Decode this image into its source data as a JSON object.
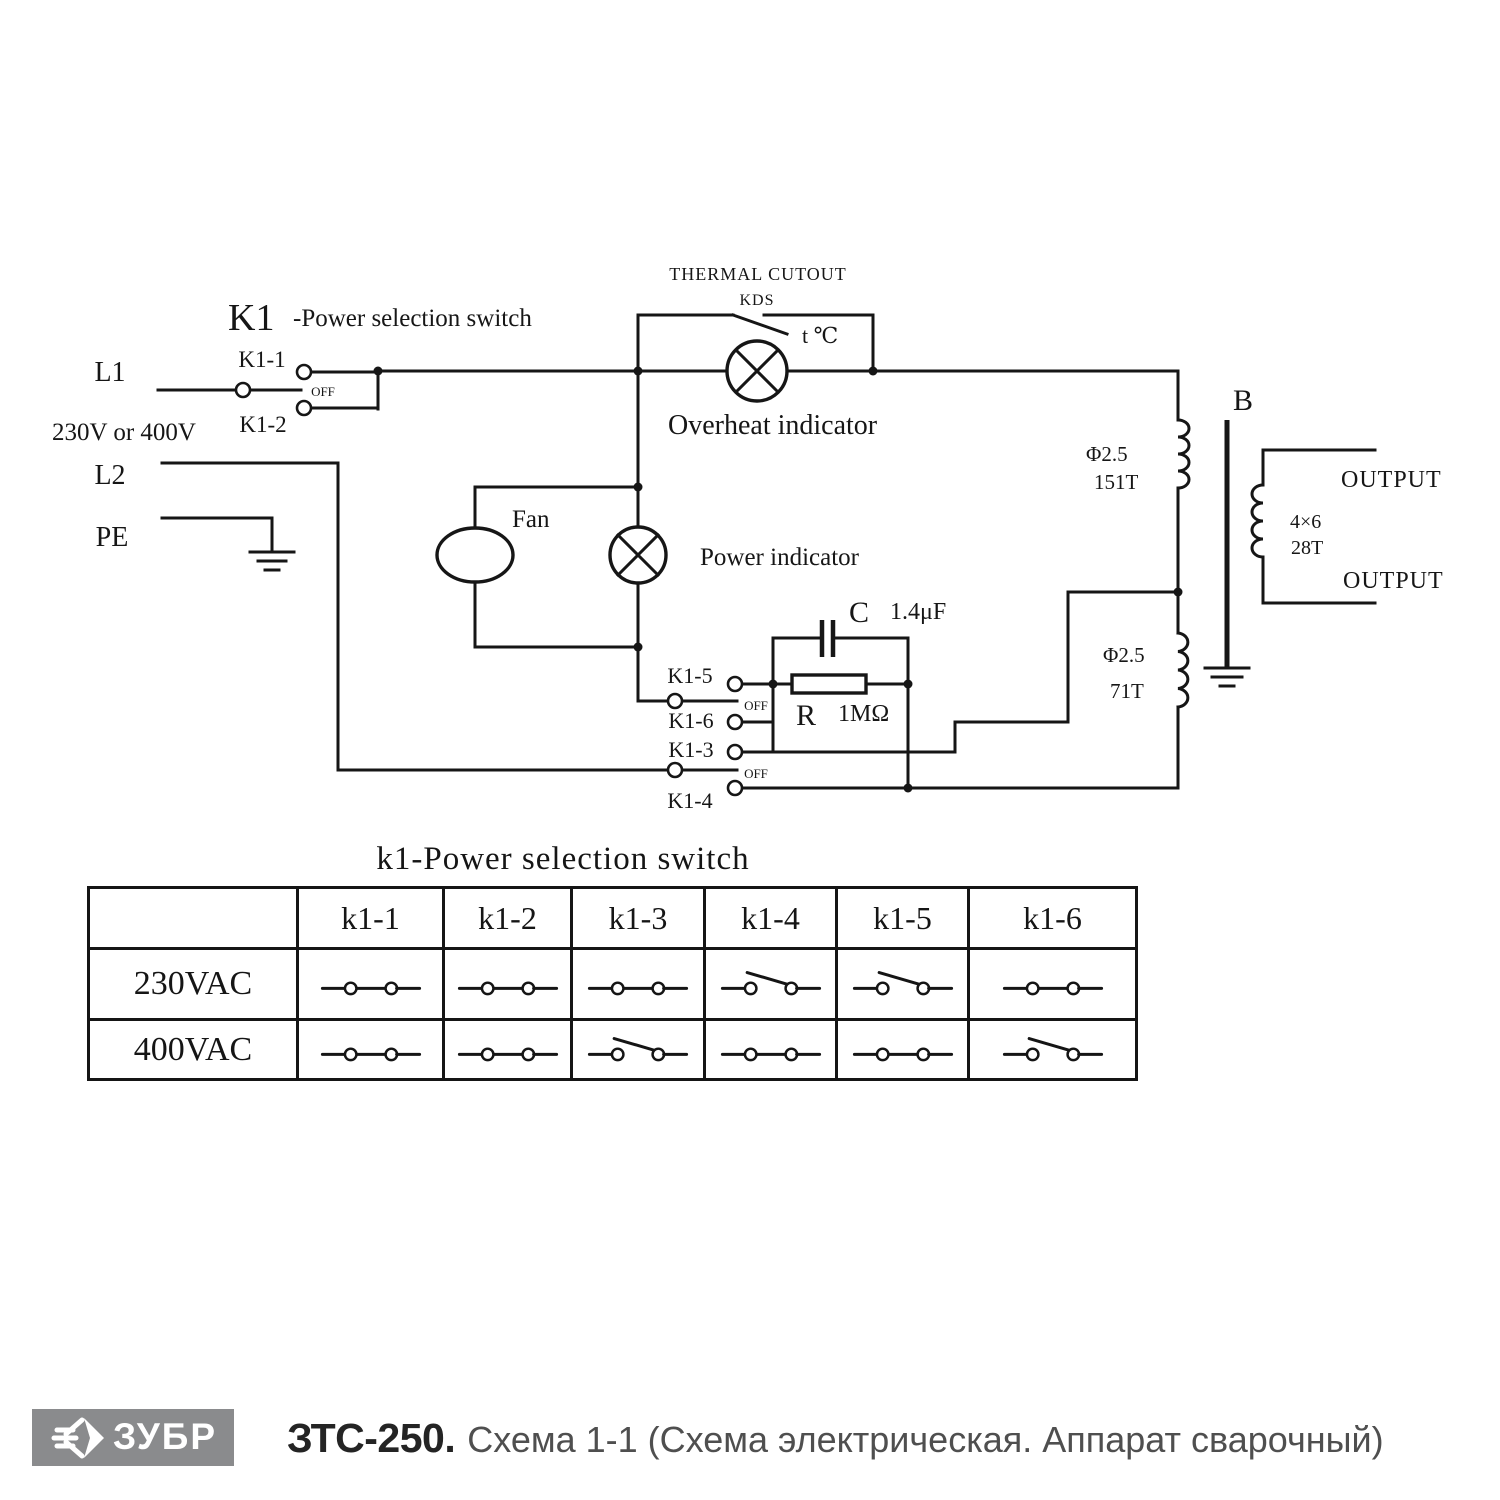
{
  "schematic": {
    "thermal_cutout": "THERMAL  CUTOUT",
    "kds": "KDS",
    "temp": "t ℃",
    "k1_title": "K1",
    "k1_subtitle": "-Power selection switch",
    "labels": {
      "l1": "L1",
      "voltage": "230V or 400V",
      "l2": "L2",
      "pe": "PE",
      "k1_1": "K1-1",
      "k1_2": "K1-2",
      "k1_3": "K1-3",
      "k1_4": "K1-4",
      "k1_5": "K1-5",
      "k1_6": "K1-6",
      "off_top": "OFF",
      "off_mid": "OFF",
      "off_bottom": "OFF",
      "overheat": "Overheat indicator",
      "power": "Power indicator",
      "fan": "Fan",
      "cap_name": "C",
      "cap_value": "1.4μF",
      "res_name": "R",
      "res_value": "1MΩ",
      "b_core": "B",
      "output_top": "OUTPUT",
      "output_bottom": "OUTPUT",
      "w151_dia": "Φ2.5",
      "w151_turns": "151T",
      "w71_dia": "Φ2.5",
      "w71_turns": "71T",
      "sec_wire": "4×6",
      "sec_turns": "28T"
    }
  },
  "table": {
    "title": "k1-Power selection switch",
    "columns": [
      "k1-1",
      "k1-2",
      "k1-3",
      "k1-4",
      "k1-5",
      "k1-6"
    ],
    "rows": [
      {
        "label": "230VAC",
        "states": [
          "closed",
          "closed",
          "closed",
          "open",
          "open",
          "closed"
        ]
      },
      {
        "label": "400VAC",
        "states": [
          "closed",
          "closed",
          "open",
          "closed",
          "closed",
          "open"
        ]
      }
    ]
  },
  "footer": {
    "brand": "ЗУБР",
    "model": "ЗТС-250.",
    "description": "Схема 1-1 (Схема электрическая. Аппарат сварочный)",
    "logo_bg": "#8a8b8d"
  }
}
